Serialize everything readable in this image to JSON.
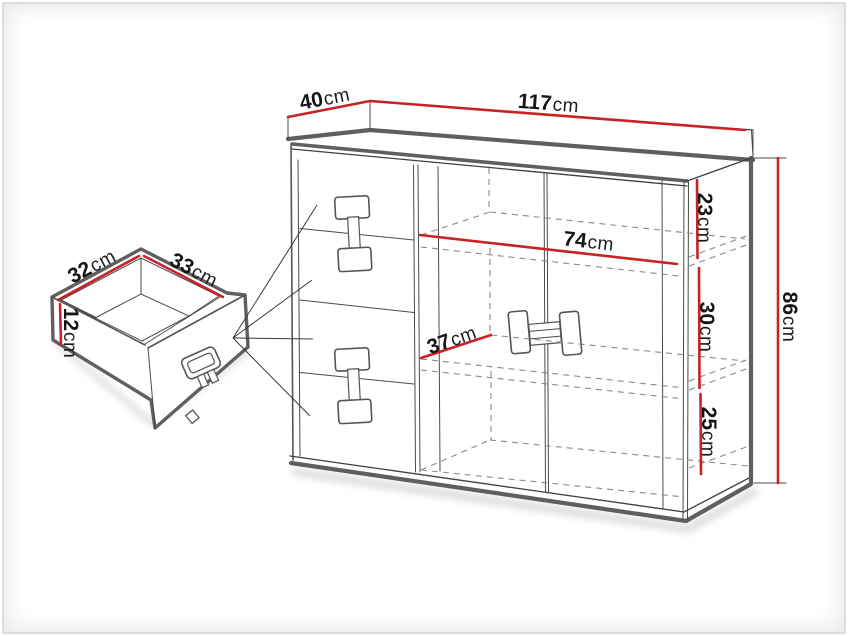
{
  "figure": {
    "kind": "furniture-dimension-diagram",
    "subject": "chest of drawers with two doors, shelves and four drawers, plus detail view of a single drawer box"
  },
  "dims": {
    "top_depth": {
      "value": "40",
      "unit": "cm"
    },
    "top_width": {
      "value": "117",
      "unit": "cm"
    },
    "section_top_height": {
      "value": "23",
      "unit": "cm"
    },
    "section_middle_height": {
      "value": "30",
      "unit": "cm"
    },
    "section_bottom_height": {
      "value": "25",
      "unit": "cm"
    },
    "total_height": {
      "value": "86",
      "unit": "cm"
    },
    "interior_width": {
      "value": "74",
      "unit": "cm"
    },
    "interior_depth": {
      "value": "37",
      "unit": "cm"
    },
    "drawer_inner_depth": {
      "value": "32",
      "unit": "cm"
    },
    "drawer_inner_width": {
      "value": "33",
      "unit": "cm"
    },
    "drawer_inner_height": {
      "value": "12",
      "unit": "cm"
    }
  },
  "colors": {
    "dimension_line": "#c92222",
    "outline_thick": "#5f5f5f",
    "outline_thin": "#3f3f3f",
    "hidden_dashed": "#8a8a8a",
    "label_text": "#161616",
    "background": "#ffffff",
    "photo_border": "#dcdcdc"
  }
}
